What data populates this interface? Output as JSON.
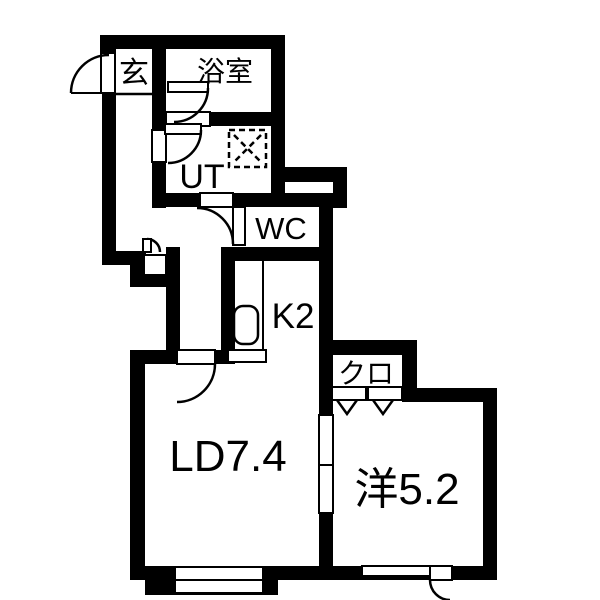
{
  "floorplan": {
    "type": "apartment-floor-plan",
    "rooms": [
      {
        "id": "genkan",
        "label": "玄"
      },
      {
        "id": "bathroom",
        "label": "浴室"
      },
      {
        "id": "utility",
        "label": "UT"
      },
      {
        "id": "wc",
        "label": "WC"
      },
      {
        "id": "kitchen",
        "label": "K2"
      },
      {
        "id": "closet",
        "label": "クロ"
      },
      {
        "id": "living_dining",
        "label": "LD7.4"
      },
      {
        "id": "western_room",
        "label": "洋5.2"
      }
    ],
    "colors": {
      "wall": "#000000",
      "floor": "#ffffff",
      "line": "#000000"
    }
  }
}
